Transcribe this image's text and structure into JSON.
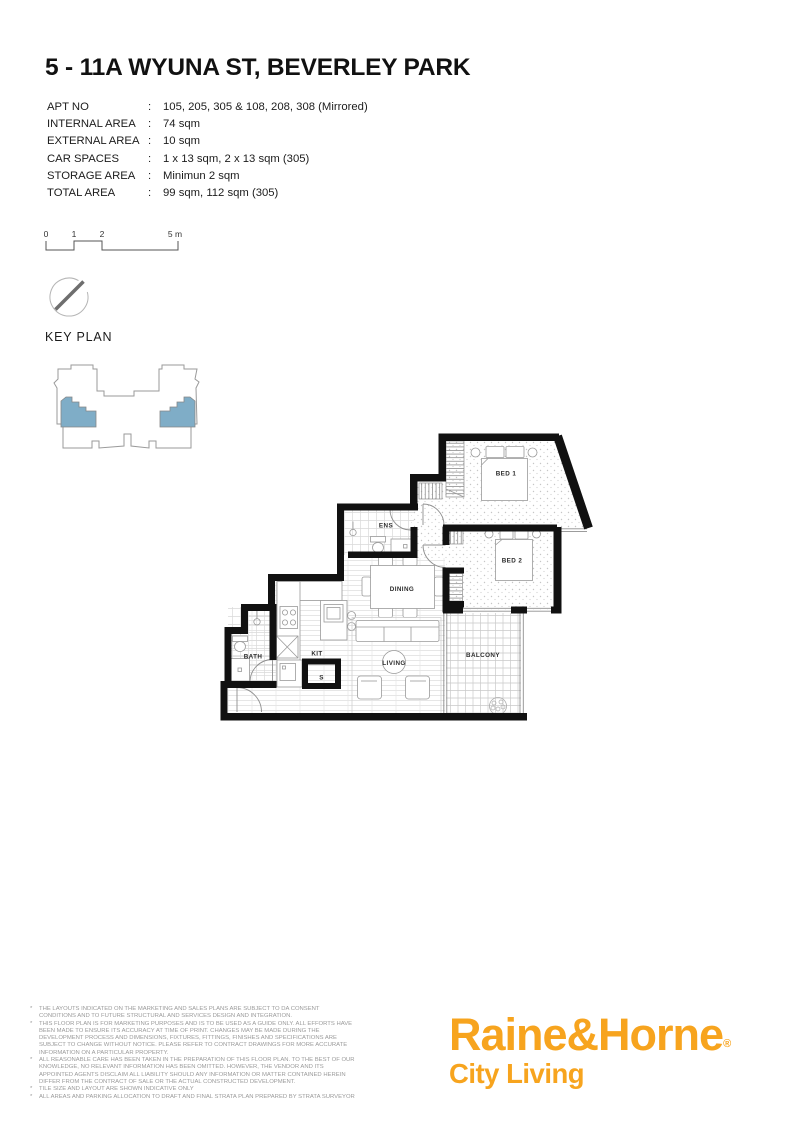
{
  "page": {
    "title": "5 - 11A WYUNA ST, BEVERLEY PARK"
  },
  "details": {
    "colon": ":",
    "rows": [
      {
        "label": "APT NO",
        "value": "105, 205, 305 & 108, 208, 308 (Mirrored)"
      },
      {
        "label": "INTERNAL AREA",
        "value": "74 sqm"
      },
      {
        "label": "EXTERNAL AREA",
        "value": "10 sqm"
      },
      {
        "label": "CAR SPACES",
        "value": "1 x 13 sqm, 2 x 13 sqm (305)"
      },
      {
        "label": "STORAGE AREA",
        "value": "Minimun 2 sqm"
      },
      {
        "label": "TOTAL AREA",
        "value": "99 sqm, 112 sqm (305)"
      }
    ]
  },
  "scale_bar": {
    "ticks": [
      "0",
      "1",
      "2",
      "5 m"
    ]
  },
  "icons": {
    "north_arrow": "compass-needle"
  },
  "key_plan": {
    "label": "KEY PLAN",
    "highlight_color": "#7fadc7"
  },
  "floor_plan": {
    "wall_color": "#111111",
    "rooms": [
      {
        "name": "BED 1"
      },
      {
        "name": "BED 2"
      },
      {
        "name": "ENS"
      },
      {
        "name": "DINING"
      },
      {
        "name": "KIT"
      },
      {
        "name": "BATH"
      },
      {
        "name": "LIVING"
      },
      {
        "name": "BALCONY"
      },
      {
        "name": "S"
      }
    ]
  },
  "disclaimer": {
    "bullet": "*",
    "items": [
      "THE LAYOUTS INDICATED ON THE MARKETING AND SALES PLANS ARE SUBJECT TO DA CONSENT CONDITIONS AND TO FUTURE STRUCTURAL AND SERVICES DESIGN AND INTEGRATION.",
      "THIS FLOOR PLAN IS FOR MARKETING PURPOSES AND IS TO BE USED AS A GUIDE ONLY. ALL EFFORTS HAVE BEEN MADE TO ENSURE ITS ACCURACY AT TIME OF PRINT. CHANGES MAY BE MADE DURING THE DEVELOPMENT PROCESS AND DIMENSIONS, FIXTURES, FITTINGS, FINISHES AND SPECIFICATIONS ARE SUBJECT TO CHANGE WITHOUT NOTICE. PLEASE REFER TO CONTRACT DRAWINGS FOR MORE ACCURATE INFORMATION ON A PARTICULAR PROPERTY.",
      "ALL REASONABLE CARE HAS BEEN TAKEN IN THE PREPARATION OF THIS FLOOR PLAN. TO THE BEST OF OUR KNOWLEDGE, NO RELEVANT INFORMATION HAS BEEN OMITTED. HOWEVER, THE VENDOR AND ITS APPOINTED AGENTS DISCLAIM ALL LIABILITY SHOULD ANY INFORMATION OR MATTER CONTAINED HEREIN DIFFER FROM THE CONTRACT OF SALE OR THE ACTUAL CONSTRUCTED DEVELOPMENT.",
      "TILE SIZE AND LAYOUT ARE SHOWN INDICATIVE ONLY",
      "ALL AREAS AND PARKING ALLOCATION TO DRAFT AND FINAL STRATA PLAN PREPARED BY STRATA SURVEYOR"
    ]
  },
  "logo": {
    "brand": "Raine&Horne",
    "registered": "®",
    "tagline": "City Living",
    "brand_color": "#f7a41e"
  }
}
